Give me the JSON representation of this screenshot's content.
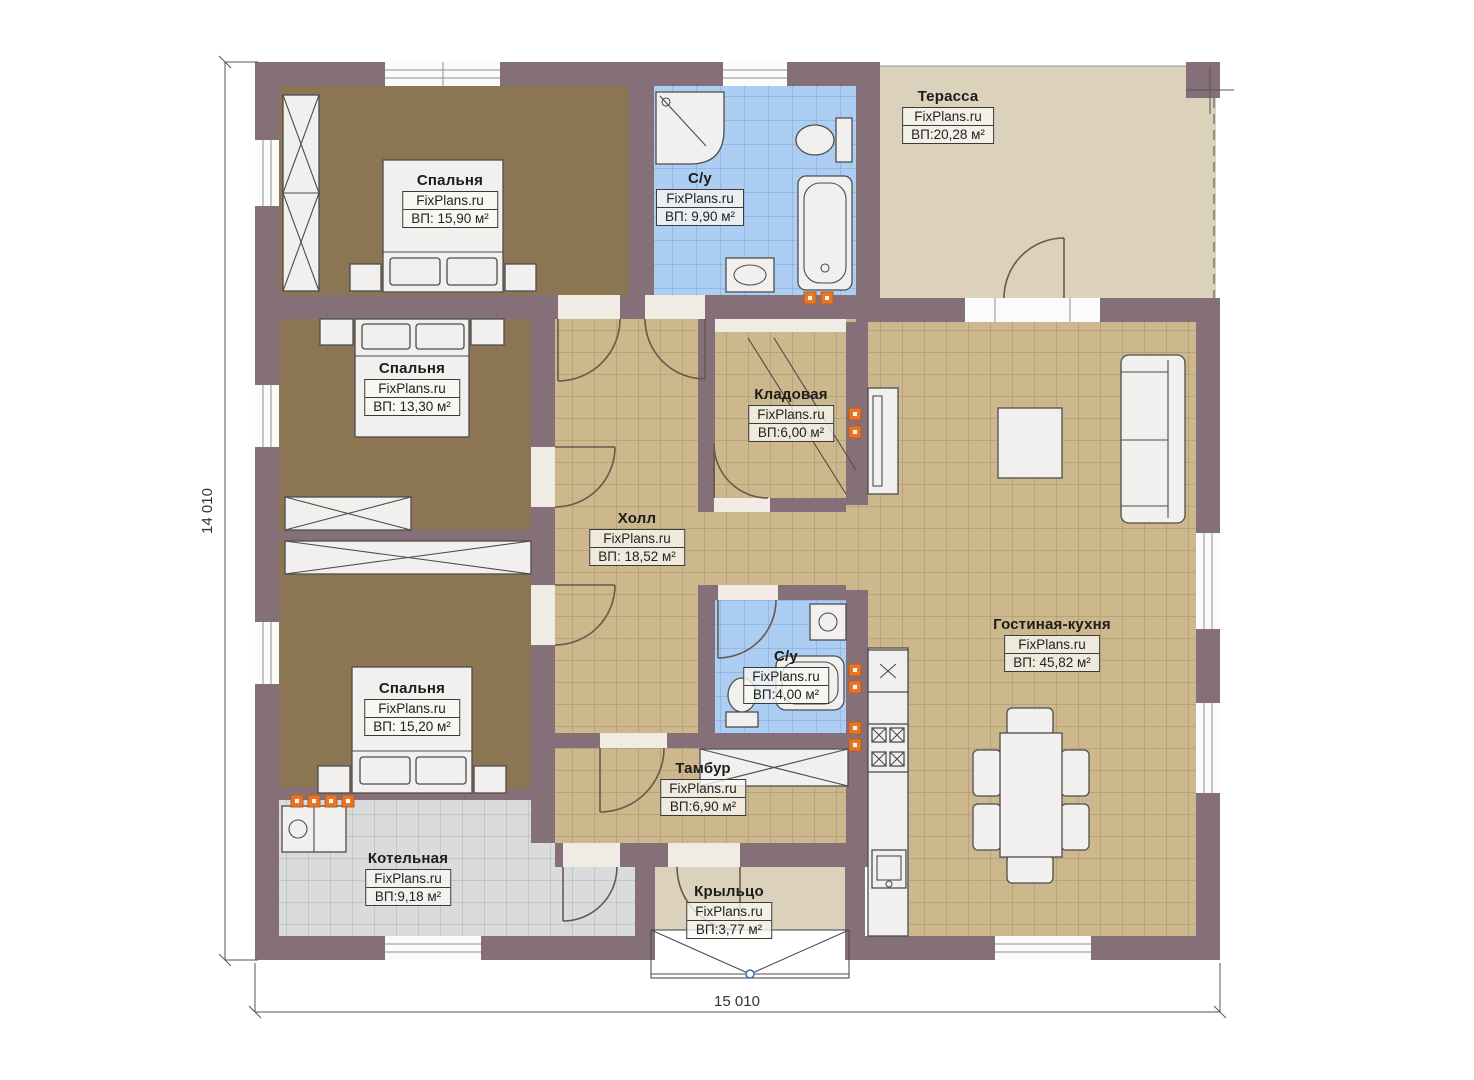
{
  "plan": {
    "watermark": "FixPlans.ru",
    "dimensions": {
      "height_label": "14 010",
      "width_label": "15 010"
    },
    "rooms": [
      {
        "id": "bedroom-1",
        "name": "Спальня",
        "area": "ВП: 15,90 м²"
      },
      {
        "id": "bathroom-main",
        "name": "С/у",
        "area": "ВП: 9,90 м²"
      },
      {
        "id": "terrace",
        "name": "Терасса",
        "area": "ВП:20,28 м²"
      },
      {
        "id": "bedroom-2",
        "name": "Спальня",
        "area": "ВП: 13,30 м²"
      },
      {
        "id": "pantry",
        "name": "Кладовая",
        "area": "ВП:6,00 м²"
      },
      {
        "id": "hall",
        "name": "Холл",
        "area": "ВП: 18,52 м²"
      },
      {
        "id": "bathroom-small",
        "name": "С/у",
        "area": "ВП:4,00 м²"
      },
      {
        "id": "living-kitchen",
        "name": "Гостиная-кухня",
        "area": "ВП: 45,82 м²"
      },
      {
        "id": "bedroom-3",
        "name": "Спальня",
        "area": "ВП: 15,20 м²"
      },
      {
        "id": "vestibule",
        "name": "Тамбур",
        "area": "ВП:6,90 м²"
      },
      {
        "id": "boiler-room",
        "name": "Котельная",
        "area": "ВП:9,18 м²"
      },
      {
        "id": "porch",
        "name": "Крыльцо",
        "area": "ВП:3,77 м²"
      }
    ],
    "colors": {
      "wall": "#857079",
      "bedroom_floor": "#8c7553",
      "tile_tan": "#cdb78c",
      "tile_blue": "#abcef2",
      "tile_gray": "#dadbdd",
      "terrace_floor": "#dcd1bb",
      "marker_orange": "#e8762a",
      "furniture": "#f1f0ee"
    }
  }
}
